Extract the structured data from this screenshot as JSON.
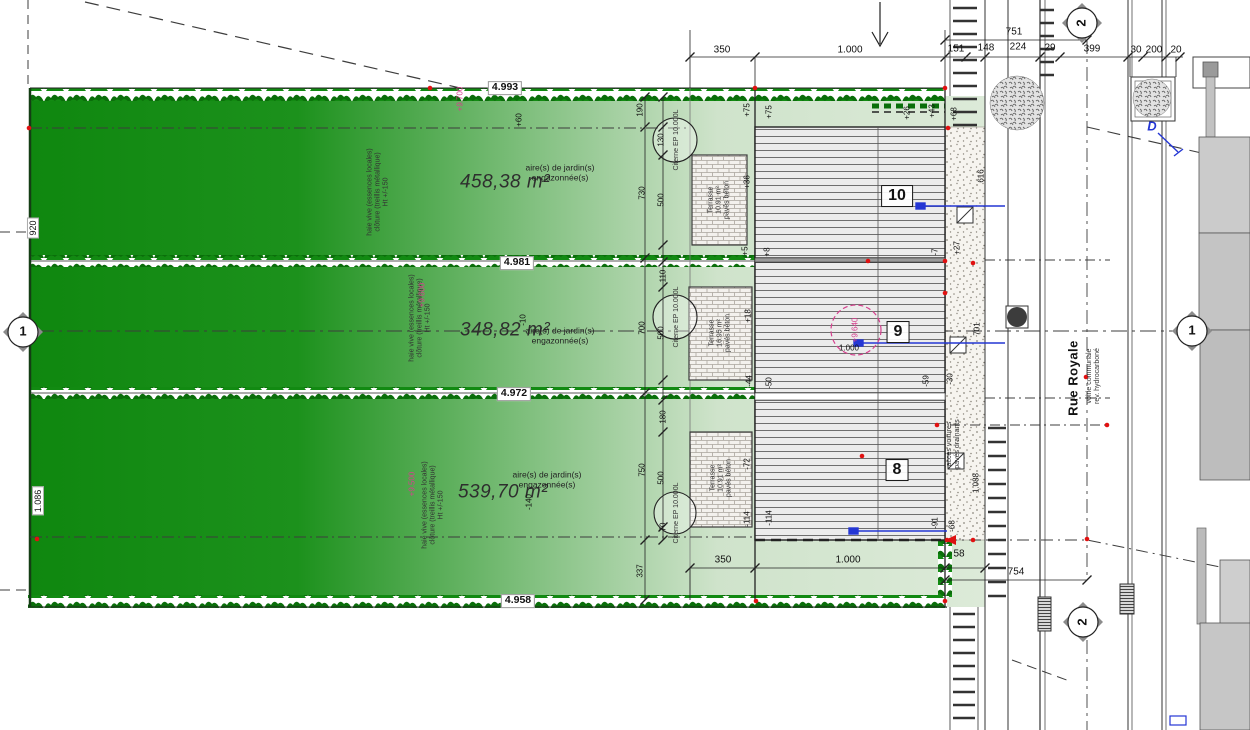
{
  "drawing": {
    "type": "architectural site plan",
    "street_name": "Rue Royale",
    "house_numbers": [
      "10",
      "9",
      "8"
    ]
  },
  "colors": {
    "grass_dark": "#0f870f",
    "grass_light": "#dcead8",
    "hedge_green": "#0a6e0a",
    "pink_accent": "#d6408e",
    "blue_accent": "#2436d4",
    "red_point": "#e11111"
  },
  "text_items": {
    "parcel_areas": [
      {
        "n": "parcel-area-top",
        "t": "458,38 m²",
        "x": 505,
        "y": 182,
        "c": "area"
      },
      {
        "n": "parcel-area-middle",
        "t": "348,82 m²",
        "x": 505,
        "y": 330,
        "c": "area"
      },
      {
        "n": "parcel-area-bottom",
        "t": "539,70 m²",
        "x": 503,
        "y": 492,
        "c": "area"
      }
    ],
    "garden_notes": [
      {
        "n": "garden-note-top",
        "t": "aire(s) de jardin(s)\nengazonnée(s)",
        "x": 560,
        "y": 173,
        "c": "note"
      },
      {
        "n": "garden-note-middle",
        "t": "aire(s) de jardin(s)\nengazonnée(s)",
        "x": 560,
        "y": 336,
        "c": "note"
      },
      {
        "n": "garden-note-bottom",
        "t": "aire(s) de jardin(s)\nengazonnée(s)",
        "x": 547,
        "y": 480,
        "c": "note"
      }
    ],
    "hedge_notes": [
      {
        "n": "hedge-note-top",
        "t": "haie vive (essences locales)\nclôture (treillis métallique)\nHt +/-150",
        "x": 378,
        "y": 192,
        "r": -90,
        "c": "tiny"
      },
      {
        "n": "hedge-note-middle",
        "t": "haie vive (essences locales)\nclôture (treillis métallique)\nHt +/-150",
        "x": 420,
        "y": 318,
        "r": -90,
        "c": "tiny"
      },
      {
        "n": "hedge-note-bottom",
        "t": "haie vive (essences locales)\nclôture (treillis métallique)\nHt +/-150",
        "x": 433,
        "y": 505,
        "r": -90,
        "c": "tiny"
      }
    ],
    "pink_levels": [
      {
        "n": "level-top",
        "t": "+9.700",
        "x": 461,
        "y": 99,
        "r": -90,
        "c": "dim-sm pink"
      },
      {
        "n": "level-middle",
        "t": "+9.600",
        "x": 423,
        "y": 295,
        "r": -90,
        "c": "dim-sm pink"
      },
      {
        "n": "level-bottom",
        "t": "+9.500",
        "x": 413,
        "y": 484,
        "r": -90,
        "c": "dim-sm pink"
      },
      {
        "n": "level-house9",
        "t": "+9.640",
        "x": 856,
        "y": 330,
        "r": -90,
        "c": "dim-sm pink"
      }
    ],
    "elevation_marks": [
      {
        "n": "elevation-4993",
        "t": "4.993",
        "x": 505,
        "y": 88,
        "c": "elev"
      },
      {
        "n": "elevation-4981",
        "t": "4.981",
        "x": 517,
        "y": 263,
        "c": "elev"
      },
      {
        "n": "elevation-4972",
        "t": "4.972",
        "x": 514,
        "y": 394,
        "c": "elev"
      },
      {
        "n": "elevation-4958",
        "t": "4.958",
        "x": 518,
        "y": 601,
        "c": "elev"
      }
    ],
    "boundary_dims": [
      {
        "n": "dim-920",
        "t": "920",
        "x": 33,
        "y": 228,
        "r": -90,
        "c": "wbox"
      },
      {
        "n": "dim-1086",
        "t": "1.086",
        "x": 38,
        "y": 501,
        "r": -90,
        "c": "wbox"
      }
    ],
    "top_dims": [
      {
        "n": "dim-350-top",
        "t": "350",
        "x": 722,
        "y": 50,
        "c": "dim"
      },
      {
        "n": "dim-1000-top",
        "t": "1.000",
        "x": 850,
        "y": 50,
        "c": "dim"
      },
      {
        "n": "dim-151",
        "t": "151",
        "x": 956,
        "y": 49,
        "c": "dim"
      },
      {
        "n": "dim-148",
        "t": "148",
        "x": 986,
        "y": 48,
        "c": "dim"
      },
      {
        "n": "dim-224",
        "t": "224",
        "x": 1018,
        "y": 47,
        "c": "dim"
      },
      {
        "n": "dim-29",
        "t": "29",
        "x": 1050,
        "y": 48,
        "c": "dim"
      },
      {
        "n": "dim-399",
        "t": "399",
        "x": 1092,
        "y": 49,
        "c": "dim"
      },
      {
        "n": "dim-30",
        "t": "30",
        "x": 1136,
        "y": 50,
        "c": "dim"
      },
      {
        "n": "dim-200",
        "t": "200",
        "x": 1154,
        "y": 50,
        "c": "dim"
      },
      {
        "n": "dim-20",
        "t": "20",
        "x": 1176,
        "y": 50,
        "c": "dim"
      },
      {
        "n": "dim-751",
        "t": "751",
        "x": 1014,
        "y": 32,
        "c": "dim"
      }
    ],
    "bottom_dims": [
      {
        "n": "dim-350-bottom",
        "t": "350",
        "x": 723,
        "y": 560,
        "c": "dim"
      },
      {
        "n": "dim-1000-bottom",
        "t": "1.000",
        "x": 848,
        "y": 560,
        "c": "dim"
      },
      {
        "n": "dim-58",
        "t": "58",
        "x": 959,
        "y": 554,
        "c": "dim"
      },
      {
        "n": "dim-754",
        "t": "754",
        "x": 1016,
        "y": 572,
        "c": "dim"
      },
      {
        "n": "dim-337",
        "t": "337",
        "x": 641,
        "y": 571,
        "r": -90,
        "c": "dim-sm"
      }
    ],
    "left_dims": [
      {
        "n": "dim-190",
        "t": "190",
        "x": 641,
        "y": 110,
        "r": -90,
        "c": "dim-sm"
      },
      {
        "n": "dim-130",
        "t": "130",
        "x": 662,
        "y": 140,
        "r": -90,
        "c": "dim-sm"
      },
      {
        "n": "dim-730",
        "t": "730",
        "x": 643,
        "y": 193,
        "r": -90,
        "c": "dim-sm"
      },
      {
        "n": "dim-500-a",
        "t": "500",
        "x": 662,
        "y": 200,
        "r": -90,
        "c": "dim-sm"
      },
      {
        "n": "dim-110",
        "t": "110",
        "x": 664,
        "y": 276,
        "r": -90,
        "c": "dim-sm"
      },
      {
        "n": "dim-700",
        "t": "700",
        "x": 643,
        "y": 328,
        "r": -90,
        "c": "dim-sm"
      },
      {
        "n": "dim-500-b",
        "t": "500",
        "x": 662,
        "y": 333,
        "r": -90,
        "c": "dim-sm"
      },
      {
        "n": "dim-180",
        "t": "180",
        "x": 664,
        "y": 417,
        "r": -90,
        "c": "dim-sm"
      },
      {
        "n": "dim-750",
        "t": "750",
        "x": 643,
        "y": 470,
        "r": -90,
        "c": "dim-sm"
      },
      {
        "n": "dim-500-c",
        "t": "500",
        "x": 662,
        "y": 478,
        "r": -90,
        "c": "dim-sm"
      },
      {
        "n": "dim-70",
        "t": "70",
        "x": 664,
        "y": 527,
        "r": -90,
        "c": "dim-sm"
      }
    ],
    "right_dims": [
      {
        "n": "dim-616",
        "t": "616",
        "x": 982,
        "y": 176,
        "r": -90,
        "c": "dim-sm"
      },
      {
        "n": "dim-701",
        "t": "701",
        "x": 978,
        "y": 329,
        "r": -90,
        "c": "dim-sm"
      },
      {
        "n": "dim-1088",
        "t": "1.088",
        "x": 977,
        "y": 483,
        "r": -90,
        "c": "dim-sm"
      },
      {
        "n": "dim-1000-house9",
        "t": "1.000",
        "x": 849,
        "y": 349,
        "c": "dim-sm"
      }
    ],
    "level_markers": [
      {
        "n": "marker-p60",
        "t": "+60",
        "x": 520,
        "y": 120,
        "r": -90,
        "c": "dim-sm"
      },
      {
        "n": "marker-m10",
        "t": "-10",
        "x": 524,
        "y": 320,
        "r": -90,
        "c": "dim-sm"
      },
      {
        "n": "marker-m140",
        "t": "-140",
        "x": 530,
        "y": 502,
        "r": -90,
        "c": "dim-sm"
      },
      {
        "n": "marker-p75-a",
        "t": "+75",
        "x": 748,
        "y": 110,
        "r": -90,
        "c": "dim-sm"
      },
      {
        "n": "marker-p75-b",
        "t": "+75",
        "x": 770,
        "y": 112,
        "r": -90,
        "c": "dim-sm"
      },
      {
        "n": "marker-p36",
        "t": "+36",
        "x": 748,
        "y": 182,
        "r": -90,
        "c": "dim-sm"
      },
      {
        "n": "marker-p5",
        "t": "+5",
        "x": 746,
        "y": 251,
        "r": -90,
        "c": "dim-sm"
      },
      {
        "n": "marker-p8",
        "t": "+8",
        "x": 768,
        "y": 252,
        "r": -90,
        "c": "dim-sm"
      },
      {
        "n": "marker-m7",
        "t": "-7",
        "x": 936,
        "y": 252,
        "r": -90,
        "c": "dim-sm"
      },
      {
        "n": "marker-p27",
        "t": "+27",
        "x": 958,
        "y": 248,
        "r": -90,
        "c": "dim-sm"
      },
      {
        "n": "marker-p26",
        "t": "+26",
        "x": 908,
        "y": 113,
        "r": -90,
        "c": "dim-sm"
      },
      {
        "n": "marker-p43",
        "t": "+43",
        "x": 933,
        "y": 111,
        "r": -90,
        "c": "dim-sm"
      },
      {
        "n": "marker-p68",
        "t": "+68",
        "x": 955,
        "y": 114,
        "r": -90,
        "c": "dim-sm"
      },
      {
        "n": "marker-p18",
        "t": "+18",
        "x": 749,
        "y": 316,
        "r": -90,
        "c": "dim-sm"
      },
      {
        "n": "marker-m44",
        "t": "-44",
        "x": 750,
        "y": 381,
        "r": -90,
        "c": "dim-sm"
      },
      {
        "n": "marker-m50",
        "t": "-50",
        "x": 770,
        "y": 383,
        "r": -90,
        "c": "dim-sm"
      },
      {
        "n": "marker-m59",
        "t": "-59",
        "x": 927,
        "y": 381,
        "r": -90,
        "c": "dim-sm"
      },
      {
        "n": "marker-m30",
        "t": "-30",
        "x": 951,
        "y": 379,
        "r": -90,
        "c": "dim-sm"
      },
      {
        "n": "marker-m72",
        "t": "-72",
        "x": 748,
        "y": 464,
        "r": -90,
        "c": "dim-sm"
      },
      {
        "n": "marker-m114-a",
        "t": "-114",
        "x": 748,
        "y": 519,
        "r": -90,
        "c": "dim-sm"
      },
      {
        "n": "marker-m114-b",
        "t": "-114",
        "x": 770,
        "y": 518,
        "r": -90,
        "c": "dim-sm"
      },
      {
        "n": "marker-m91",
        "t": "-91",
        "x": 936,
        "y": 523,
        "r": -90,
        "c": "dim-sm"
      },
      {
        "n": "marker-m68",
        "t": "-68",
        "x": 953,
        "y": 526,
        "r": -90,
        "c": "dim-sm"
      }
    ],
    "house_numbers": [
      {
        "n": "house-number-10",
        "t": "10",
        "x": 897,
        "y": 196,
        "c": "house-no"
      },
      {
        "n": "house-number-9",
        "t": "9",
        "x": 898,
        "y": 332,
        "c": "house-no"
      },
      {
        "n": "house-number-8",
        "t": "8",
        "x": 897,
        "y": 470,
        "c": "house-no"
      }
    ],
    "terrace_labels": [
      {
        "n": "terrace-label-10",
        "t": "Terrasse\n10.91 m²\npavés béton",
        "x": 719,
        "y": 200,
        "r": -90,
        "c": "tiny"
      },
      {
        "n": "terrace-label-9",
        "t": "Terrasse\n16.95 m²\npavés béton",
        "x": 720,
        "y": 333,
        "r": -90,
        "c": "tiny"
      },
      {
        "n": "terrace-label-8",
        "t": "Terrasse\n10.91 m²\npavés béton",
        "x": 721,
        "y": 478,
        "r": -90,
        "c": "tiny"
      }
    ],
    "cistern_labels": [
      {
        "n": "cistern-label-10",
        "t": "Citerne EP 10.000L",
        "x": 677,
        "y": 140,
        "r": -90,
        "c": "tiny"
      },
      {
        "n": "cistern-label-9",
        "t": "Citerne EP 10.000L",
        "x": 677,
        "y": 317,
        "r": -90,
        "c": "tiny"
      },
      {
        "n": "cistern-label-8",
        "t": "Citerne EP 10.000L",
        "x": 677,
        "y": 513,
        "r": -90,
        "c": "tiny"
      }
    ],
    "street_labels": [
      {
        "n": "street-name",
        "t": "Rue Royale",
        "x": 1074,
        "y": 378,
        "r": -90,
        "c": "street"
      },
      {
        "n": "street-note",
        "t": "voirie communale\nrev. hydrocarboné",
        "x": 1094,
        "y": 376,
        "r": -90,
        "c": "tiny"
      },
      {
        "n": "driveway-note",
        "t": "accès voitures\npavés drainants",
        "x": 954,
        "y": 444,
        "r": -90,
        "c": "tiny"
      }
    ],
    "grid_bubbles": [
      {
        "n": "grid-bubble-1-left",
        "t": "1",
        "x": 23,
        "y": 332,
        "c": "bubble"
      },
      {
        "n": "grid-bubble-1-right",
        "t": "1",
        "x": 1192,
        "y": 331,
        "c": "bubble"
      },
      {
        "n": "grid-bubble-2-top",
        "t": "2",
        "x": 1082,
        "y": 23,
        "r": -90,
        "c": "bubble"
      },
      {
        "n": "grid-bubble-2-bottom",
        "t": "2",
        "x": 1083,
        "y": 622,
        "r": -90,
        "c": "bubble"
      }
    ],
    "annotations": [
      {
        "n": "tree-marker-d",
        "t": "D",
        "x": 1152,
        "y": 127,
        "c": "blue"
      }
    ]
  }
}
